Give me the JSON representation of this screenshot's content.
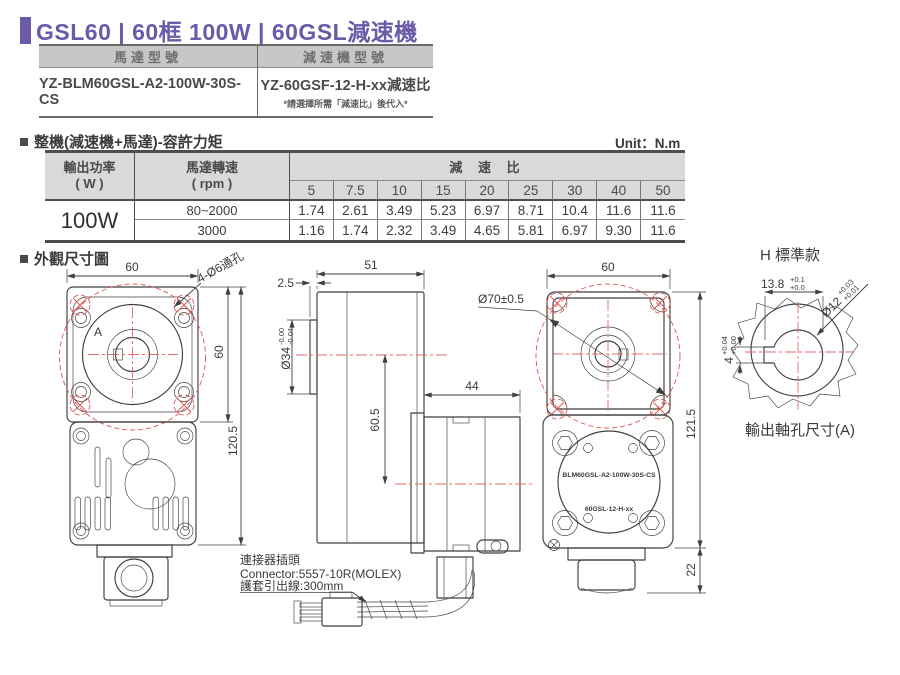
{
  "header": {
    "title": "GSL60 | 60框 100W | 60GSL減速機"
  },
  "model_table": {
    "motor_header": "馬達型號",
    "gearbox_header": "減速機型號",
    "motor_model": "YZ-BLM60GSL-A2-100W-30S-CS",
    "gearbox_model": "YZ-60GSF-12-H-xx減速比",
    "gearbox_note": "*請選擇所需「減速比」後代入*"
  },
  "torque_table": {
    "section_title": "整機(減速機+馬達)-容許力矩",
    "unit_label": "Unit：N.m",
    "power_header": "輸出功率",
    "power_unit": "( W )",
    "speed_header": "馬達轉速",
    "speed_unit": "( rpm )",
    "ratio_header": "減 速 比",
    "ratio_columns": [
      "5",
      "7.5",
      "10",
      "15",
      "20",
      "25",
      "30",
      "40",
      "50"
    ],
    "power_value": "100W",
    "rows": [
      {
        "speed": "80~2000",
        "values": [
          "1.74",
          "2.61",
          "3.49",
          "5.23",
          "6.97",
          "8.71",
          "10.4",
          "11.6",
          "11.6"
        ]
      },
      {
        "speed": "3000",
        "values": [
          "1.16",
          "1.74",
          "2.32",
          "3.49",
          "4.65",
          "5.81",
          "6.97",
          "9.30",
          "11.6"
        ]
      }
    ]
  },
  "dimension_section": {
    "title": "外觀尺寸圖"
  },
  "front_view": {
    "dim_width": "60",
    "hole_callout": "4-Ø6通孔",
    "label_a": "A",
    "dim_height": "60",
    "dim_total_height": "120.5"
  },
  "side_view": {
    "dim_boss": "2.5",
    "dim_length": "51",
    "dim_pilot": "Ø34",
    "pilot_tol_up": "-0.00",
    "pilot_tol_dn": "-0.04",
    "dim_axis_offset": "60.5",
    "dim_motor_length": "44",
    "connector_label_zh": "連接器插頭",
    "connector_model": "Connector:5557-10R(MOLEX)",
    "connector_lead": "護套引出線:300mm"
  },
  "rear_view": {
    "dim_width": "60",
    "dim_bolt_circle": "Ø70±0.5",
    "dim_height": "121.5",
    "dim_cap_height": "22",
    "motor_label": "BLM60GSL-A2-100W-30S-CS",
    "gearbox_label": "60GSL-12-H-xx"
  },
  "shaft_detail": {
    "title": "H 標準款",
    "caption": "輸出軸孔尺寸(A)",
    "dim_flat": "13.8",
    "flat_tol_up": "+0.1",
    "flat_tol_dn": "+0.0",
    "dim_bore": "Ø12",
    "bore_tol_up": "+0.03",
    "bore_tol_dn": "+0.01",
    "dim_key": "4",
    "key_tol_up": "+0.04",
    "key_tol_dn": "+0.00"
  }
}
